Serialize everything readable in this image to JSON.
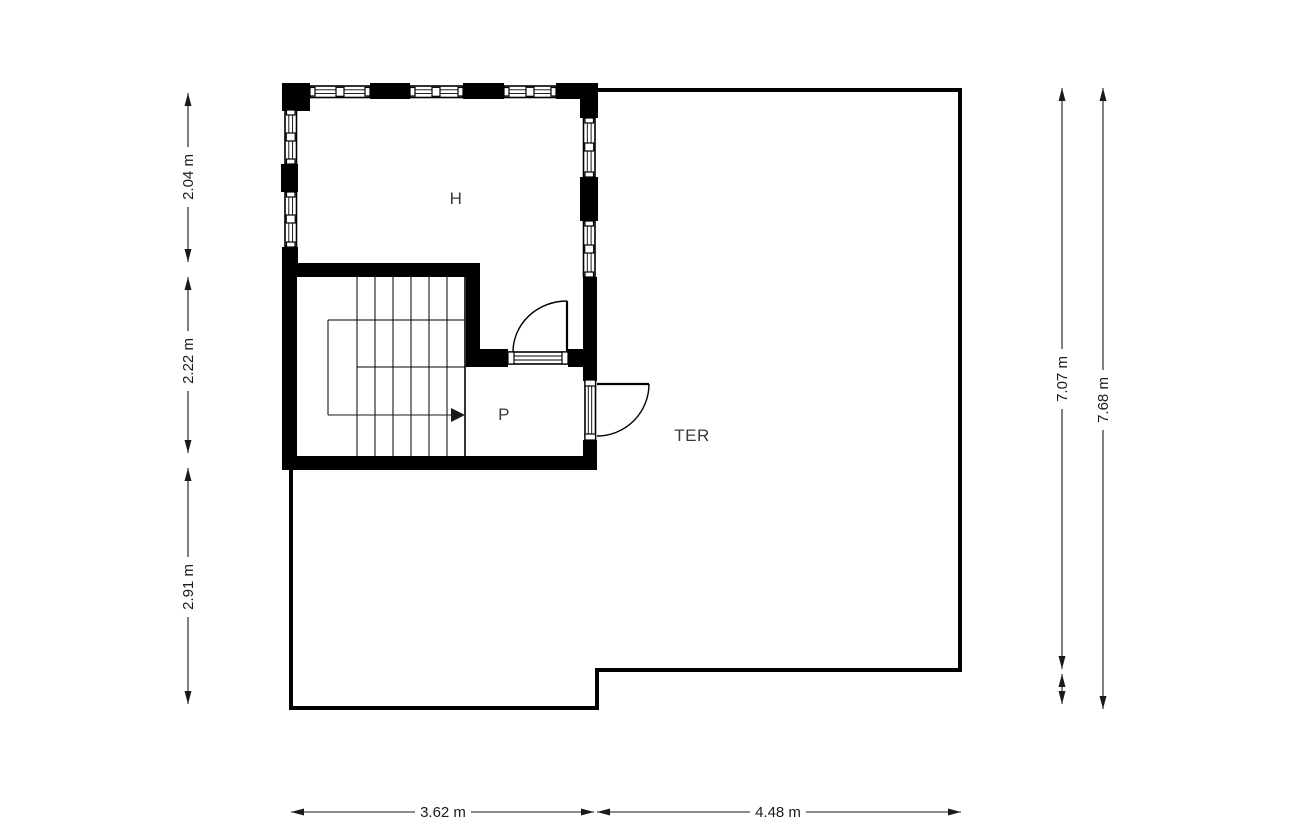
{
  "rooms": {
    "h": "H",
    "p": "P",
    "ter": "TER"
  },
  "dimensions": {
    "left_top": "2.04 m",
    "left_middle": "2.22 m",
    "left_bottom": "2.91 m",
    "right_inner": "7.07 m",
    "right_outer": "7.68 m",
    "bottom_left": "3.62 m",
    "bottom_right": "4.48 m"
  },
  "colors": {
    "wall": "#000000",
    "line": "#1a1a1a",
    "label": "#3a3a3a",
    "background": "#ffffff"
  }
}
